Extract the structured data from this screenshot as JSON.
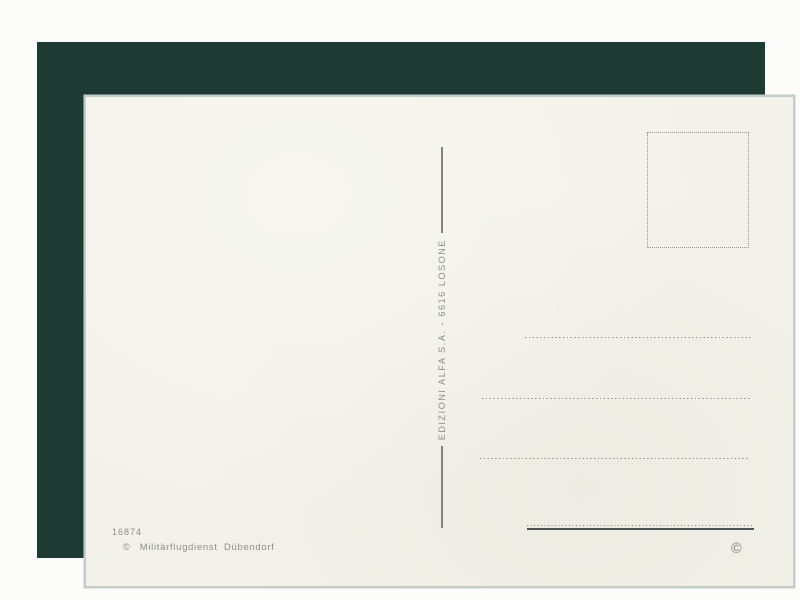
{
  "postcard": {
    "publisher_imprint": "EDIZIONI ALFA S.A. - 6616 LOSONE",
    "serial_number": "16874",
    "credit_symbol": "©",
    "credit_text": "Militärflugdienst Dübendorf",
    "copyright_mark": "©"
  },
  "colors": {
    "page_bg": "#fcfcfa",
    "mat_bg": "#1e3b33",
    "card_bg": "#f3f2ea",
    "card_edge": "#c4cec8",
    "ink_gray": "#8c8d86",
    "dot_gray": "#90918a",
    "rule_gray": "#83847e",
    "solid_line": "#4e5355"
  }
}
